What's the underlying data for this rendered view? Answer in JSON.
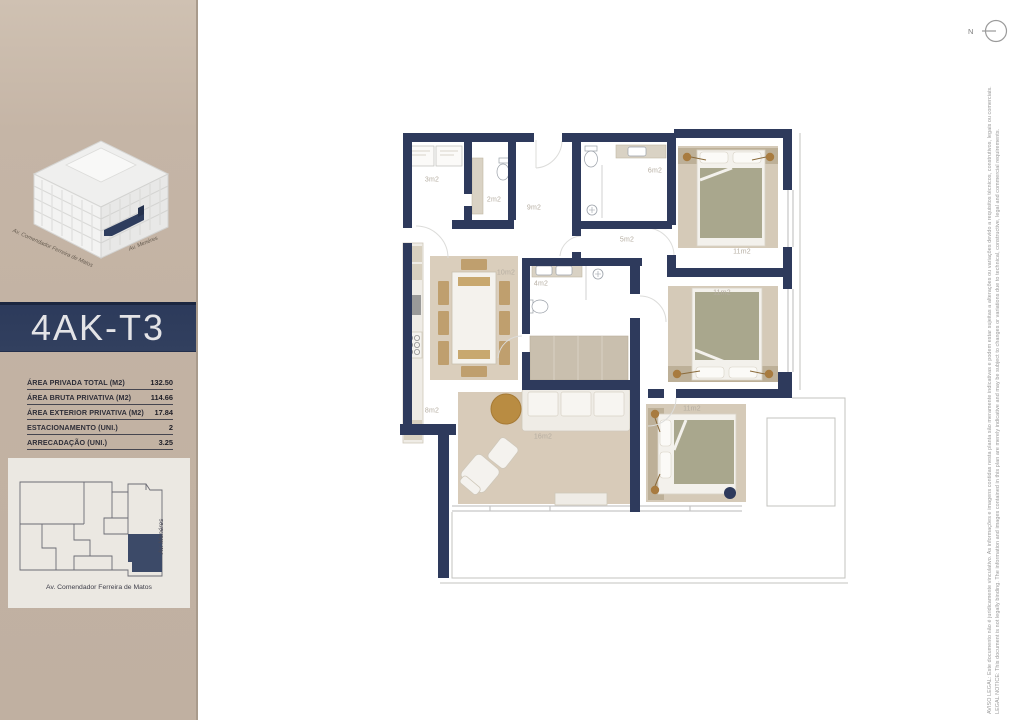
{
  "colors": {
    "wall_navy": "#2e3a5c",
    "sidebar_beige": "#c2b2a3",
    "title_band_navy": "#2f3d5e",
    "keyplan_highlight": "#3c4a68"
  },
  "north": {
    "label": "N"
  },
  "sidebar": {
    "building": {
      "street_left": "Av. Comendador Ferreira de Matos",
      "street_right": "Av. Menéres"
    },
    "unit_title": "4AK-T3",
    "specs": [
      {
        "label": "ÁREA PRIVADA TOTAL (M2)",
        "value": "132.50"
      },
      {
        "label": "ÁREA BRUTA PRIVATIVA (M2)",
        "value": "114.66"
      },
      {
        "label": "ÁREA EXTERIOR PRIVATIVA (M2)",
        "value": "17.84"
      },
      {
        "label": "ESTACIONAMENTO (UNI.)",
        "value": "2"
      },
      {
        "label": "ARRECADAÇÃO (UNI.)",
        "value": "3.25"
      }
    ],
    "keyplan": {
      "street_right": "Av. Menéres",
      "street_bottom": "Av. Comendador Ferreira de Matos"
    }
  },
  "floorplan": {
    "rooms": [
      {
        "id": "laundry",
        "area_label": "3m2"
      },
      {
        "id": "wc",
        "area_label": "2m2"
      },
      {
        "id": "hall",
        "area_label": "9m2"
      },
      {
        "id": "bath-top",
        "area_label": "6m2"
      },
      {
        "id": "corridor",
        "area_label": "5m2"
      },
      {
        "id": "bedroom-1",
        "area_label": "11m2"
      },
      {
        "id": "bedroom-2",
        "area_label": "11m2"
      },
      {
        "id": "bedroom-3",
        "area_label": "11m2"
      },
      {
        "id": "kitchen",
        "area_label": "8m2"
      },
      {
        "id": "dining",
        "area_label": "10m2"
      },
      {
        "id": "bath-main",
        "area_label": "4m2"
      },
      {
        "id": "living",
        "area_label": "16m2"
      }
    ]
  },
  "legal": {
    "pt": "AVISO LEGAL: Este documento não é juridicamente vinculativo. As informações e imagens contidas nesta planta são meramente indicativas e podem estar sujeitas a alterações ou variações devido a requisitos técnicos, construtivos, legais ou comerciais.",
    "en": "LEGAL NOTICE: This document is not legally binding. The information and images contained in this plan are merely indicative and may be subject to changes or variations due to technical, constructive, legal and commercial requirements."
  }
}
